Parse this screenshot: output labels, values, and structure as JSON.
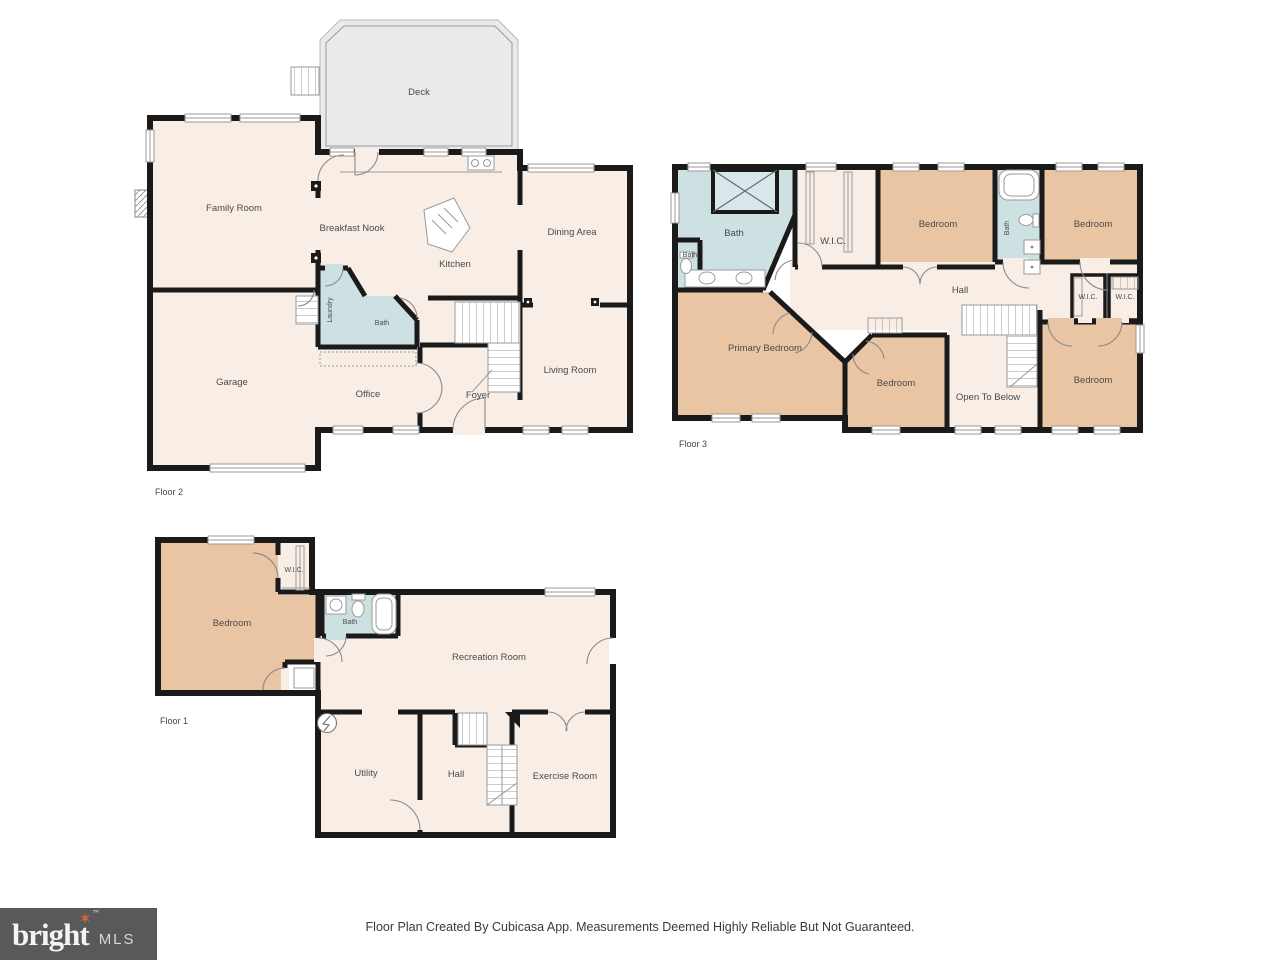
{
  "colors": {
    "room_cream": "#F9EEE5",
    "room_tan": "#EAC5A4",
    "room_blue": "#CDE1E3",
    "shower_blue": "#D8E7E9",
    "deck_gray": "#EAEAEC",
    "wall": "#1A1A1A",
    "label_text": "#4A4A4A",
    "logo_bg": "#58595B",
    "logo_star": "#D9603B"
  },
  "floors": [
    {
      "label": "Floor 2",
      "rooms": [
        {
          "label": "Deck"
        },
        {
          "label": "Family Room"
        },
        {
          "label": "Breakfast Nook"
        },
        {
          "label": "Kitchen"
        },
        {
          "label": "Dining Area"
        },
        {
          "label": "Living Room"
        },
        {
          "label": "Garage"
        },
        {
          "label": "Laundry"
        },
        {
          "label": "Bath"
        },
        {
          "label": "Office"
        },
        {
          "label": "Foyer"
        }
      ]
    },
    {
      "label": "Floor 3",
      "rooms": [
        {
          "label": "Bath"
        },
        {
          "label": "Bath"
        },
        {
          "label": "W.I.C."
        },
        {
          "label": "Bedroom"
        },
        {
          "label": "Bath"
        },
        {
          "label": "Bedroom"
        },
        {
          "label": "Hall"
        },
        {
          "label": "W.I.C."
        },
        {
          "label": "W.I.C."
        },
        {
          "label": "Primary Bedroom"
        },
        {
          "label": "Bedroom"
        },
        {
          "label": "Open To Below"
        },
        {
          "label": "Bedroom"
        }
      ]
    },
    {
      "label": "Floor 1",
      "rooms": [
        {
          "label": "Bedroom"
        },
        {
          "label": "W.I.C."
        },
        {
          "label": "Bath"
        },
        {
          "label": "Recreation Room"
        },
        {
          "label": "Utility"
        },
        {
          "label": "Hall"
        },
        {
          "label": "Exercise Room"
        }
      ]
    }
  ],
  "footer": {
    "disclaimer": "Floor Plan Created By Cubicasa App. Measurements Deemed Highly Reliable But Not Guaranteed.",
    "logo": {
      "brand": "bright",
      "suffix": "MLS",
      "tm": "™",
      "star": "✶"
    }
  }
}
